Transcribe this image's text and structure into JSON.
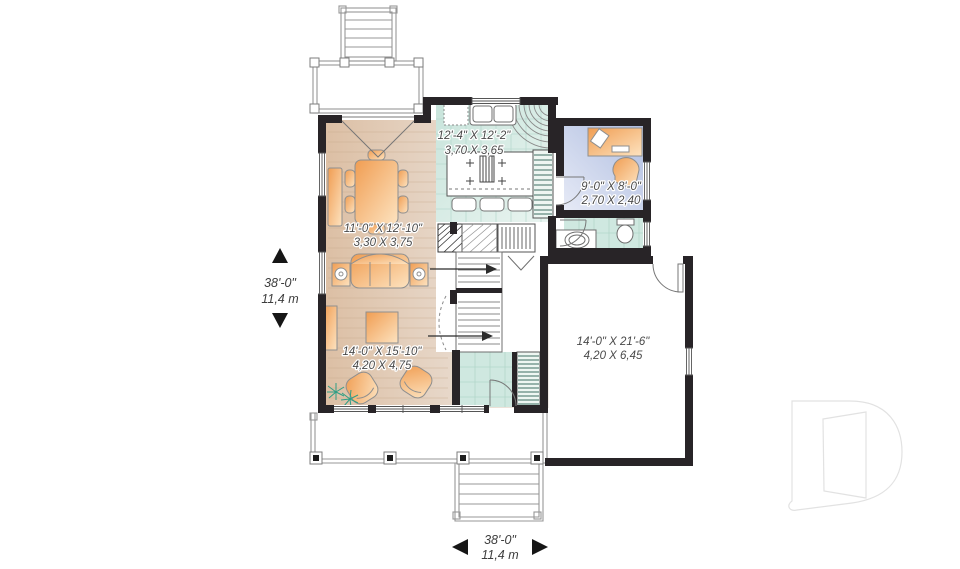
{
  "plan": {
    "rooms": {
      "kitchen": {
        "imperial": "12'-4\" X 12'-2\"",
        "metric": "3,70 X 3,65"
      },
      "office": {
        "imperial": "9'-0\" X 8'-0\"",
        "metric": "2,70 X 2,40"
      },
      "dining": {
        "imperial": "11'-0\" X 12'-10\"",
        "metric": "3,30 X 3,75"
      },
      "living": {
        "imperial": "14'-0\" X 15'-10\"",
        "metric": "4,20 X 4,75"
      },
      "garage": {
        "imperial": "14'-0\" X 21'-6\"",
        "metric": "4,20 X 6,45"
      }
    },
    "overall": {
      "left": {
        "imperial": "38'-0\"",
        "metric": "11,4 m"
      },
      "bottom": {
        "imperial": "38'-0\"",
        "metric": "11,4 m"
      }
    },
    "colors": {
      "wall": "#282427",
      "wood_floor": "#dcbfa4",
      "tile": "#cfe8e0",
      "office_floor": "#afbde0",
      "furniture": "#f09d52",
      "plant": "#2f9e85",
      "label_text": "#4a4a4a",
      "watermark": "#e4e4e4"
    },
    "icons": {
      "watermark": "drummond-d-logo",
      "stair_arrow": "arrow-right",
      "dimension_arrows": "triangle-arrows"
    }
  }
}
